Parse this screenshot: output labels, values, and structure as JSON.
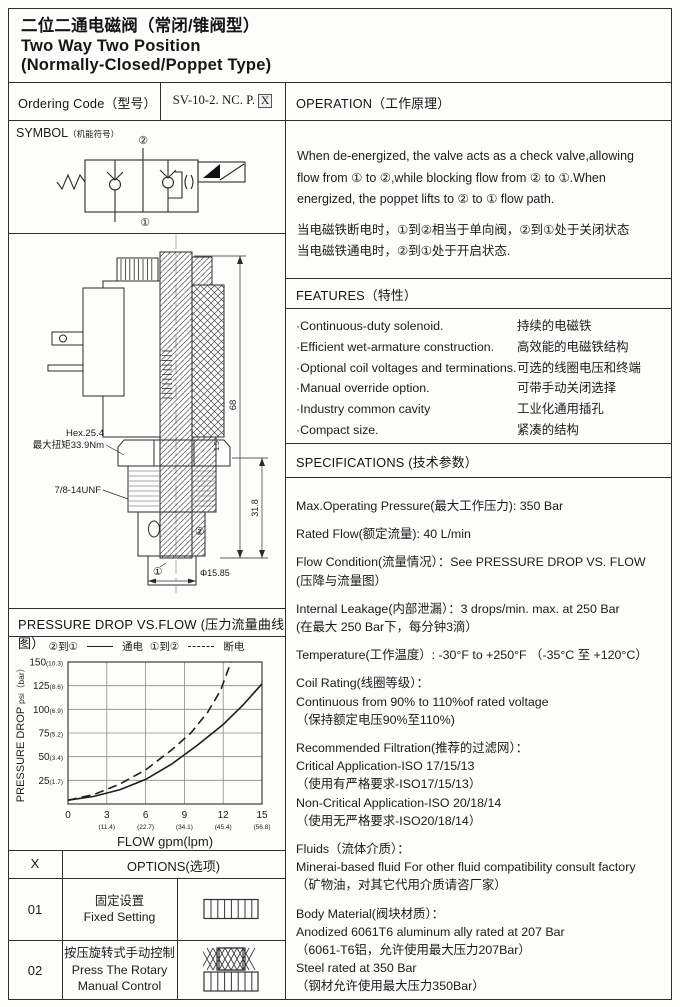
{
  "page_title": {
    "zh": "二位二通电磁阀（常闭/锥阀型）",
    "en1": "Two Way Two Position",
    "en2": "(Normally-Closed/Poppet Type)"
  },
  "ordering": {
    "label": "Ordering Code（型号）",
    "code": "SV-10-2. NC. P.",
    "code_suffix": "X"
  },
  "symbol": {
    "title": "SYMBOL",
    "title_zh": "（机能符号）",
    "port_top": "②",
    "port_bottom": "①"
  },
  "drawing": {
    "hex_label1": "Hex.25.4",
    "hex_label2": "最大扭矩33.9Nm",
    "thread_label": "7/8-14UNF",
    "dim_height": "68",
    "dim_lower": "31.8",
    "dim_small": "1.5",
    "dim_dia": "Φ15.85",
    "port1": "①",
    "port2": "②"
  },
  "chart_header": "PRESSURE DROP VS.FLOW  (压力流量曲线图）",
  "chart_data": {
    "type": "line",
    "title": "PRESSURE DROP VS.FLOW (压力流量曲线图）",
    "xlabel": "FLOW gpm(lpm)",
    "ylabel": "PRESSURE DROP psi（bar）",
    "xlim": [
      0,
      15
    ],
    "ylim": [
      0,
      150
    ],
    "grid": true,
    "legend_position": "top",
    "x_ticks": [
      {
        "v": 0,
        "gpm": "0",
        "lpm": ""
      },
      {
        "v": 3,
        "gpm": "3",
        "lpm": "(11.4)"
      },
      {
        "v": 6,
        "gpm": "6",
        "lpm": "(22.7)"
      },
      {
        "v": 9,
        "gpm": "9",
        "lpm": "(34.1)"
      },
      {
        "v": 12,
        "gpm": "12",
        "lpm": "(45.4)"
      },
      {
        "v": 15,
        "gpm": "15",
        "lpm": "(56.8)"
      }
    ],
    "y_ticks": [
      {
        "v": 25,
        "psi": "25",
        "bar": "(1.7)"
      },
      {
        "v": 50,
        "psi": "50",
        "bar": "(3.4)"
      },
      {
        "v": 75,
        "psi": "75",
        "bar": "(5.2)"
      },
      {
        "v": 100,
        "psi": "100",
        "bar": "(6.9)"
      },
      {
        "v": 125,
        "psi": "125",
        "bar": "(8.6)"
      },
      {
        "v": 150,
        "psi": "150",
        "bar": "(10.3)"
      }
    ],
    "legend": [
      {
        "ports": "②到①",
        "style": "solid",
        "label": "通电"
      },
      {
        "ports": "①到②",
        "style": "dashed",
        "label": "断电"
      }
    ],
    "series": [
      {
        "name": "②到① 通电",
        "style": "solid",
        "points": [
          [
            0,
            4
          ],
          [
            2,
            8
          ],
          [
            4,
            15
          ],
          [
            6,
            26
          ],
          [
            8,
            42
          ],
          [
            10,
            62
          ],
          [
            12,
            84
          ],
          [
            13.5,
            104
          ],
          [
            15,
            127
          ]
        ]
      },
      {
        "name": "①到② 断电",
        "style": "dashed",
        "points": [
          [
            0,
            4
          ],
          [
            2,
            10
          ],
          [
            4,
            21
          ],
          [
            6,
            36
          ],
          [
            8,
            57
          ],
          [
            9.5,
            75
          ],
          [
            10.8,
            97
          ],
          [
            11.8,
            120
          ],
          [
            12.6,
            150
          ]
        ]
      }
    ]
  },
  "operation": {
    "title": "OPERATION（工作原理）",
    "en": "When de-energized, the valve acts as a check valve,allowing flow from ① to ②,while blocking flow from ② to ①.When energized, the poppet lifts to ② to ① flow path.",
    "zh1": "当电磁铁断电时，①到②相当于单向阀，②到①处于关闭状态",
    "zh2": "当电磁铁通电时，②到①处于开启状态."
  },
  "features": {
    "title": "FEATURES（特性）",
    "items": [
      {
        "en": "·Continuous-duty  solenoid.",
        "zh": "持续的电磁铁"
      },
      {
        "en": "·Efficient wet-armature construction.",
        "zh": "高效能的电磁铁结构"
      },
      {
        "en": "·Optional coil voltages and terminations.",
        "zh": "可选的线圈电压和终端"
      },
      {
        "en": "·Manual override option.",
        "zh": "可带手动关闭选择"
      },
      {
        "en": "·Industry common cavity",
        "zh": "工业化通用插孔"
      },
      {
        "en": "·Compact size.",
        "zh": "紧凑的结构"
      }
    ]
  },
  "specifications": {
    "title": "SPECIFICATIONS (技术参数）",
    "items": [
      [
        "Max.Operating Pressure(最大工作压力): 350 Bar"
      ],
      [
        "Rated Flow(额定流量): 40 L/min"
      ],
      [
        "Flow Condition(流量情况）：See PRESSURE DROP VS. FLOW",
        "(压降与流量图）"
      ],
      [
        "Internal Leakage(内部泄漏）：3 drops/min. max. at 250 Bar",
        "(在最大 250 Bar下，每分钟3滴）"
      ],
      [
        "Temperature(工作温度）: -30°F to +250°F （-35°C 至 +120°C）"
      ],
      [
        "Coil Rating(线圈等级）：",
        "Continuous from 90% to 110%of rated voltage",
        "（保持额定电压90%至110%)"
      ],
      [
        "Recommended Filtration(推荐的过滤网）：",
        "Critical Application-ISO 17/15/13",
        "（使用有严格要求-ISO17/15/13）",
        "Non-Critical Application-ISO 20/18/14",
        "（使用无严格要求-ISO20/18/14）"
      ],
      [
        "Fluids（流体介质）：",
        "Minerai-based fluid For other  fluid compatibility consult  factory",
        "（矿物油，对其它代用介质请咨厂家）"
      ],
      [
        "Body Material(阀块材质）：",
        "Anodized 6061T6 aluminum ally rated at 207 Bar",
        "（6061-T6铝，允许使用最大压力207Bar）",
        "Steel rated at 350 Bar",
        "（钢材允许使用最大压力350Bar）"
      ]
    ]
  },
  "options": {
    "col_x": "X",
    "col_options": "OPTIONS(选项)",
    "rows": [
      {
        "code": "01",
        "lines": [
          "固定设置",
          "Fixed Setting"
        ],
        "icon": "fixed-setting-icon"
      },
      {
        "code": "02",
        "lines": [
          "按压旋转式手动控制",
          "Press The Rotary",
          "Manual Control"
        ],
        "icon": "rotary-knob-icon"
      }
    ]
  },
  "colors": {
    "line": "#2e2e2e",
    "text": "#1b1b1b",
    "grid": "#8a8a8a"
  }
}
